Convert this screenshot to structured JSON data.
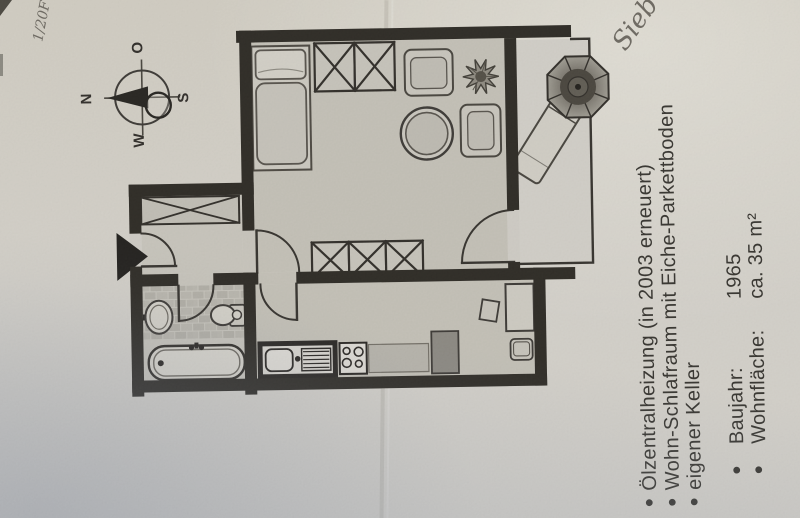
{
  "photo_annotations": {
    "corner_mark": "1/20F",
    "handwritten_note": "Sieb"
  },
  "compass": {
    "north": "N",
    "east": "O",
    "south": "S",
    "west": "W"
  },
  "listing": {
    "features": [
      "Ölzentralheizung (in 2003 erneuert)",
      "Wohn-Schlafraum mit Eiche-Parkettboden",
      "eigener Keller"
    ],
    "facts": [
      {
        "label": "Baujahr:",
        "value": "1965"
      },
      {
        "label": "Wohnfläche:",
        "value": "ca. 35 m²"
      }
    ]
  },
  "colors": {
    "paper": "#d2cfc8",
    "floor": "#c2bfb5",
    "wall": "#2b2822",
    "ink": "#34322d"
  }
}
